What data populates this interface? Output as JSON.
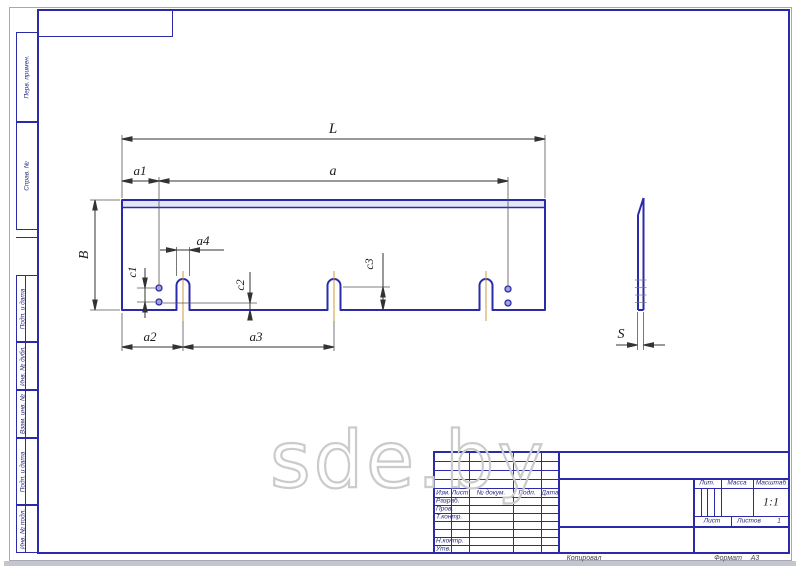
{
  "watermark": "sde.by",
  "left_strip": {
    "labels": [
      "Перв. примен.",
      "Справ. №",
      "Подп. и дата",
      "Инв. № дубл.",
      "Взам. инв. №",
      "Подп. и дата",
      "Инв. № подл."
    ]
  },
  "dims": {
    "L": "L",
    "a": "a",
    "a1": "a1",
    "a2": "a2",
    "a3": "a3",
    "a4": "a4",
    "B": "B",
    "c1": "c1",
    "c2": "c2",
    "c3": "c3",
    "S": "S"
  },
  "title_block": {
    "header": {
      "izm": "Изм.",
      "list": "Лист",
      "doc_no": "№ докум.",
      "podp": "Подп.",
      "date": "Дата"
    },
    "rows": {
      "razrab": "Разраб.",
      "prov": "Пров.",
      "t_kontr": "Т.контр.",
      "n_kontr": "Н.контр.",
      "utv": "Утв."
    },
    "lit": "Лит.",
    "massa": "Масса",
    "masshtab": "Масштаб",
    "scale": "1:1",
    "list": "Лист",
    "listov": "Листов",
    "listov_value": "1"
  },
  "margin": {
    "kopiroval": "Копировал",
    "format": "Формат",
    "format_value": "А3"
  }
}
